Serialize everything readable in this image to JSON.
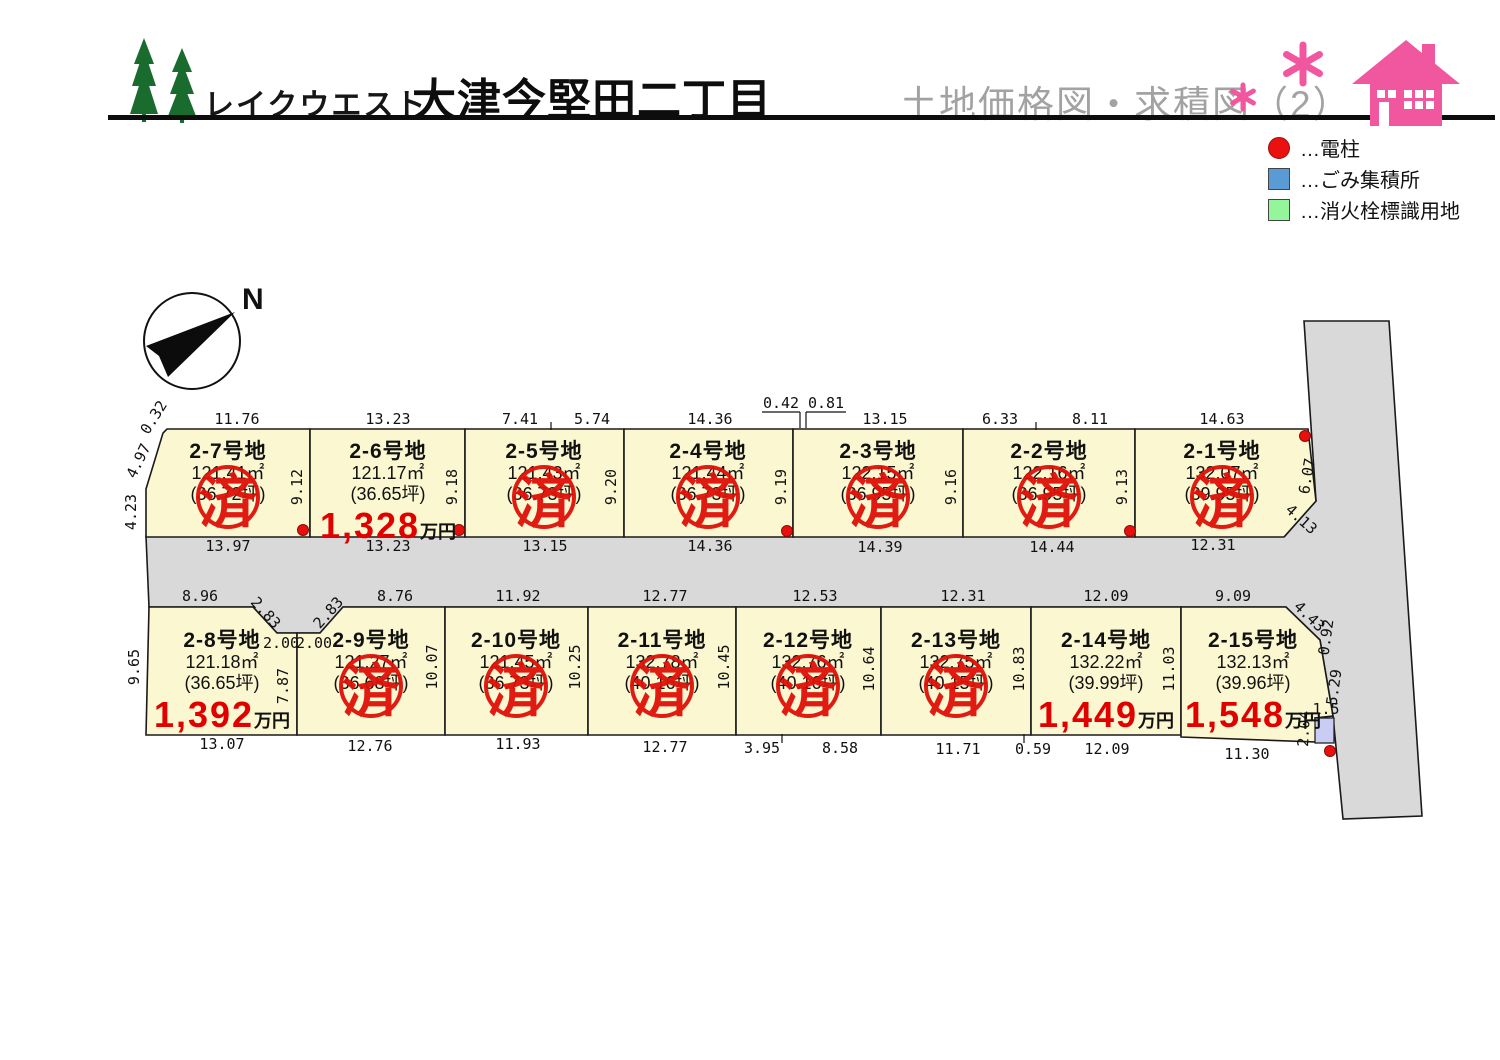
{
  "header": {
    "brand": "レイクウエスト",
    "title": "大津今堅田二丁目",
    "subtitle": "土地価格図・求積図（2）",
    "colors": {
      "title_gray": "#a2a2a2",
      "pink": "#f1579f",
      "tree_green": "#1a6b2e"
    }
  },
  "legend": {
    "items": [
      {
        "label": "…電柱",
        "shape": "circle",
        "color": "#ea1110"
      },
      {
        "label": "…ごみ集積所",
        "shape": "square",
        "color": "#5b9bd5"
      },
      {
        "label": "…消火栓標識用地",
        "shape": "square",
        "color": "#94f59a"
      }
    ]
  },
  "compass": {
    "label": "N"
  },
  "map": {
    "colors": {
      "lot_fill": "#fbf7d0",
      "road_fill": "#d9d9d9",
      "stamp_red": "#df1108",
      "price_red": "#e00000",
      "trash_fill": "#c9cdf4",
      "pole_red": "#e8100c"
    },
    "price_unit": "万円",
    "sold_stamp_text": "済",
    "road": {
      "points": "146,536 1285,536 1316,501 1304,321 1389,321 1422,816 1343,819 1333,716 1320,640 1286,607 343,607 320,633 277,633 253,607 149,607"
    },
    "trash_point": {
      "x": 1315,
      "y": 718,
      "w": 19,
      "h": 25
    },
    "power_poles": [
      [
        303,
        530
      ],
      [
        459,
        530
      ],
      [
        787,
        531
      ],
      [
        1130,
        531
      ],
      [
        1305,
        436
      ],
      [
        1330,
        751
      ]
    ],
    "ticks": [
      [
        551,
        422,
        551,
        430
      ],
      [
        1036,
        422,
        1036,
        430
      ],
      [
        762,
        412,
        800,
        412
      ],
      [
        800,
        412,
        800,
        428
      ],
      [
        806,
        412,
        846,
        412
      ],
      [
        806,
        412,
        806,
        428
      ],
      [
        782,
        734,
        782,
        743
      ],
      [
        1024,
        734,
        1024,
        743
      ]
    ],
    "lots": [
      {
        "id": "2-7",
        "name": "2-7号地",
        "area": "121.41㎡",
        "tsubo": "(36.72坪)",
        "price": null,
        "sold": true,
        "cx": 228,
        "text_y": 441,
        "stamp_cy": 497,
        "poly": "167,429 310,429 310,537 146,537 146,489 163,433"
      },
      {
        "id": "2-6",
        "name": "2-6号地",
        "area": "121.17㎡",
        "tsubo": "(36.65坪)",
        "price": "1,328",
        "sold": false,
        "cx": 388,
        "text_y": 441,
        "poly": "310,429 465,429 465,537 310,537"
      },
      {
        "id": "2-5",
        "name": "2-5号地",
        "area": "121.43㎡",
        "tsubo": "(36.73坪)",
        "price": null,
        "sold": true,
        "cx": 544,
        "text_y": 441,
        "stamp_cy": 497,
        "poly": "465,429 624,429 624,537 465,537"
      },
      {
        "id": "2-4",
        "name": "2-4号地",
        "area": "121.44㎡",
        "tsubo": "(36.73坪)",
        "price": null,
        "sold": true,
        "cx": 708,
        "text_y": 441,
        "stamp_cy": 497,
        "poly": "624,429 793,429 793,537 624,537"
      },
      {
        "id": "2-3",
        "name": "2-3号地",
        "area": "122.15㎡",
        "tsubo": "(36.95坪)",
        "price": null,
        "sold": true,
        "cx": 878,
        "text_y": 441,
        "stamp_cy": 497,
        "poly": "793,429 963,429 963,537 793,537"
      },
      {
        "id": "2-2",
        "name": "2-2号地",
        "area": "122.16㎡",
        "tsubo": "(36.95坪)",
        "price": null,
        "sold": true,
        "cx": 1049,
        "text_y": 441,
        "stamp_cy": 497,
        "poly": "963,429 1135,429 1135,537 963,537"
      },
      {
        "id": "2-1",
        "name": "2-1号地",
        "area": "132.07㎡",
        "tsubo": "(39.95坪)",
        "price": null,
        "sold": true,
        "cx": 1222,
        "text_y": 441,
        "stamp_cy": 497,
        "poly": "1135,429 1308,429 1316,501 1284,537 1135,537"
      },
      {
        "id": "2-8",
        "name": "2-8号地",
        "area": "121.18㎡",
        "tsubo": "(36.65坪)",
        "price": "1,392",
        "sold": false,
        "cx": 222,
        "text_y": 630,
        "poly": "149,607 253,607 277,633 297,633 297,735 146,735"
      },
      {
        "id": "2-9",
        "name": "2-9号地",
        "area": "121.27㎡",
        "tsubo": "(36.68坪)",
        "price": null,
        "sold": true,
        "cx": 371,
        "text_y": 630,
        "stamp_cy": 686,
        "poly": "297,633 320,633 343,607 445,607 445,735 297,735"
      },
      {
        "id": "2-10",
        "name": "2-10号地",
        "area": "121.45㎡",
        "tsubo": "(36.73坪)",
        "price": null,
        "sold": true,
        "cx": 516,
        "text_y": 630,
        "stamp_cy": 686,
        "poly": "445,607 588,607 588,735 445,735"
      },
      {
        "id": "2-11",
        "name": "2-11号地",
        "area": "132.78㎡",
        "tsubo": "(40.16坪)",
        "price": null,
        "sold": true,
        "cx": 662,
        "text_y": 630,
        "stamp_cy": 686,
        "poly": "588,607 736,607 736,735 588,735"
      },
      {
        "id": "2-12",
        "name": "2-12号地",
        "area": "132.76㎡",
        "tsubo": "(40.16坪)",
        "price": null,
        "sold": true,
        "cx": 808,
        "text_y": 630,
        "stamp_cy": 686,
        "poly": "736,607 881,607 881,735 736,735"
      },
      {
        "id": "2-13",
        "name": "2-13号地",
        "area": "132.75㎡",
        "tsubo": "(40.15坪)",
        "price": null,
        "sold": true,
        "cx": 956,
        "text_y": 630,
        "stamp_cy": 686,
        "poly": "881,607 1031,607 1031,735 881,735"
      },
      {
        "id": "2-14",
        "name": "2-14号地",
        "area": "132.22㎡",
        "tsubo": "(39.99坪)",
        "price": "1,449",
        "sold": false,
        "cx": 1106,
        "text_y": 630,
        "poly": "1031,607 1181,607 1181,735 1031,735"
      },
      {
        "id": "2-15",
        "name": "2-15号地",
        "area": "132.13㎡",
        "tsubo": "(39.96坪)",
        "price": "1,548",
        "sold": false,
        "cx": 1253,
        "text_y": 630,
        "poly": "1181,607 1286,607 1320,640 1333,716 1315,718 1317,742 1181,737"
      }
    ],
    "dim_labels": [
      {
        "t": "11.76",
        "x": 237,
        "y": 424
      },
      {
        "t": "13.23",
        "x": 388,
        "y": 424
      },
      {
        "t": "7.41",
        "x": 520,
        "y": 424
      },
      {
        "t": "5.74",
        "x": 592,
        "y": 424
      },
      {
        "t": "14.36",
        "x": 710,
        "y": 424
      },
      {
        "t": "0.42",
        "x": 781,
        "y": 408
      },
      {
        "t": "0.81",
        "x": 826,
        "y": 408
      },
      {
        "t": "13.15",
        "x": 885,
        "y": 424
      },
      {
        "t": "6.33",
        "x": 1000,
        "y": 424
      },
      {
        "t": "8.11",
        "x": 1090,
        "y": 424
      },
      {
        "t": "14.63",
        "x": 1222,
        "y": 424
      },
      {
        "t": "0.32",
        "x": 158,
        "y": 420,
        "r": -58
      },
      {
        "t": "4.97",
        "x": 143,
        "y": 463,
        "r": -64
      },
      {
        "t": "4.23",
        "x": 136,
        "y": 512,
        "r": -90
      },
      {
        "t": "9.12",
        "x": 302,
        "y": 487,
        "r": -90
      },
      {
        "t": "9.18",
        "x": 457,
        "y": 487,
        "r": -90
      },
      {
        "t": "9.20",
        "x": 616,
        "y": 487,
        "r": -90
      },
      {
        "t": "9.19",
        "x": 786,
        "y": 487,
        "r": -90
      },
      {
        "t": "9.16",
        "x": 956,
        "y": 487,
        "r": -90
      },
      {
        "t": "9.13",
        "x": 1127,
        "y": 487,
        "r": -90
      },
      {
        "t": "6.07",
        "x": 1312,
        "y": 477,
        "r": -80
      },
      {
        "t": "4.13",
        "x": 1298,
        "y": 523,
        "r": 42
      },
      {
        "t": "13.97",
        "x": 228,
        "y": 551
      },
      {
        "t": "13.23",
        "x": 388,
        "y": 551
      },
      {
        "t": "13.15",
        "x": 545,
        "y": 551
      },
      {
        "t": "14.36",
        "x": 710,
        "y": 551
      },
      {
        "t": "14.39",
        "x": 880,
        "y": 552
      },
      {
        "t": "14.44",
        "x": 1052,
        "y": 552
      },
      {
        "t": "12.31",
        "x": 1213,
        "y": 550
      },
      {
        "t": "8.96",
        "x": 200,
        "y": 601
      },
      {
        "t": "2.83",
        "x": 262,
        "y": 616,
        "r": 48
      },
      {
        "t": "2.83",
        "x": 332,
        "y": 616,
        "r": -48
      },
      {
        "t": "2.00",
        "x": 281,
        "y": 648
      },
      {
        "t": "2.00",
        "x": 314,
        "y": 648
      },
      {
        "t": "8.76",
        "x": 395,
        "y": 601
      },
      {
        "t": "11.92",
        "x": 518,
        "y": 601
      },
      {
        "t": "12.77",
        "x": 665,
        "y": 601
      },
      {
        "t": "12.53",
        "x": 815,
        "y": 601
      },
      {
        "t": "12.31",
        "x": 963,
        "y": 601
      },
      {
        "t": "12.09",
        "x": 1106,
        "y": 601
      },
      {
        "t": "9.09",
        "x": 1233,
        "y": 601
      },
      {
        "t": "4.43",
        "x": 1306,
        "y": 620,
        "r": 44
      },
      {
        "t": "0.92",
        "x": 1331,
        "y": 638,
        "r": -82
      },
      {
        "t": "5.29",
        "x": 1339,
        "y": 688,
        "r": -82
      },
      {
        "t": "1.5",
        "x": 1326,
        "y": 714
      },
      {
        "t": "2.04",
        "x": 1309,
        "y": 729,
        "r": -87
      },
      {
        "t": "9.65",
        "x": 139,
        "y": 667,
        "r": -90
      },
      {
        "t": "7.87",
        "x": 288,
        "y": 686,
        "r": -90
      },
      {
        "t": "10.07",
        "x": 437,
        "y": 667,
        "r": -90
      },
      {
        "t": "10.25",
        "x": 580,
        "y": 667,
        "r": -90
      },
      {
        "t": "10.45",
        "x": 729,
        "y": 667,
        "r": -90
      },
      {
        "t": "10.64",
        "x": 874,
        "y": 669,
        "r": -90
      },
      {
        "t": "10.83",
        "x": 1024,
        "y": 669,
        "r": -90
      },
      {
        "t": "11.03",
        "x": 1174,
        "y": 669,
        "r": -90
      },
      {
        "t": "13.07",
        "x": 222,
        "y": 749
      },
      {
        "t": "12.76",
        "x": 370,
        "y": 751
      },
      {
        "t": "11.93",
        "x": 518,
        "y": 749
      },
      {
        "t": "12.77",
        "x": 665,
        "y": 752
      },
      {
        "t": "3.95",
        "x": 762,
        "y": 753
      },
      {
        "t": "8.58",
        "x": 840,
        "y": 753
      },
      {
        "t": "11.71",
        "x": 958,
        "y": 754
      },
      {
        "t": "0.59",
        "x": 1033,
        "y": 754
      },
      {
        "t": "12.09",
        "x": 1107,
        "y": 754
      },
      {
        "t": "11.30",
        "x": 1247,
        "y": 759
      }
    ]
  }
}
